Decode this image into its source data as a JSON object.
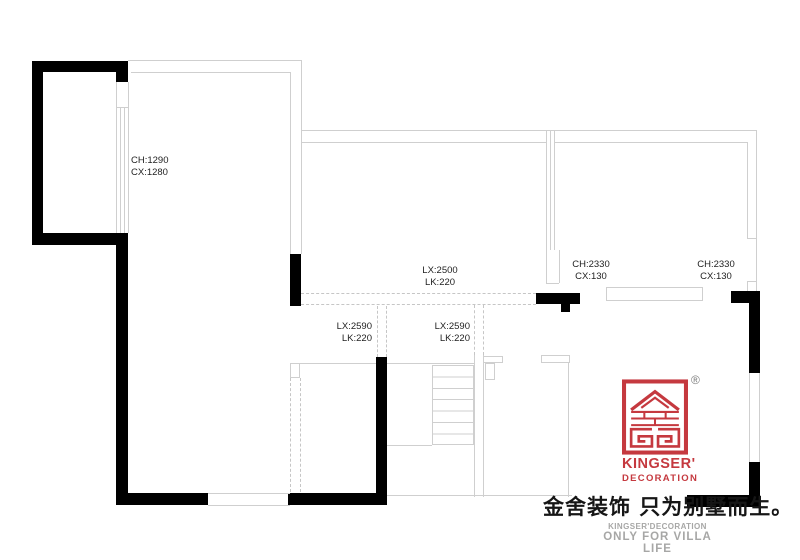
{
  "colors": {
    "wall": "#000000",
    "thin_line": "#cfcfcf",
    "dashed_line": "#c6c6c6",
    "brand_red": "#c5393f",
    "ink": "#1f1f1f",
    "footer_gray": "#a7a7a6"
  },
  "labels": {
    "window_left": {
      "l1": "CH:1290",
      "l2": "CX:1280"
    },
    "beam_mid": {
      "l1": "LX:2500",
      "l2": "LK:220"
    },
    "beam_left": {
      "l1": "LX:2590",
      "l2": "LK:220"
    },
    "beam_right": {
      "l1": "LX:2590",
      "l2": "LK:220"
    },
    "door_mid": {
      "l1": "CH:2330",
      "l2": "CX:130"
    },
    "door_right": {
      "l1": "CH:2330",
      "l2": "CX:130"
    }
  },
  "branding": {
    "logo_text": "KINGSER'",
    "logo_subtext": "DECORATION",
    "registered_mark": "®",
    "slogan": "金舍装饰 只为别墅而生。",
    "footer_en_1": "KINGSER'DECORATION",
    "footer_en_2": "ONLY FOR VILLA LIFE"
  }
}
